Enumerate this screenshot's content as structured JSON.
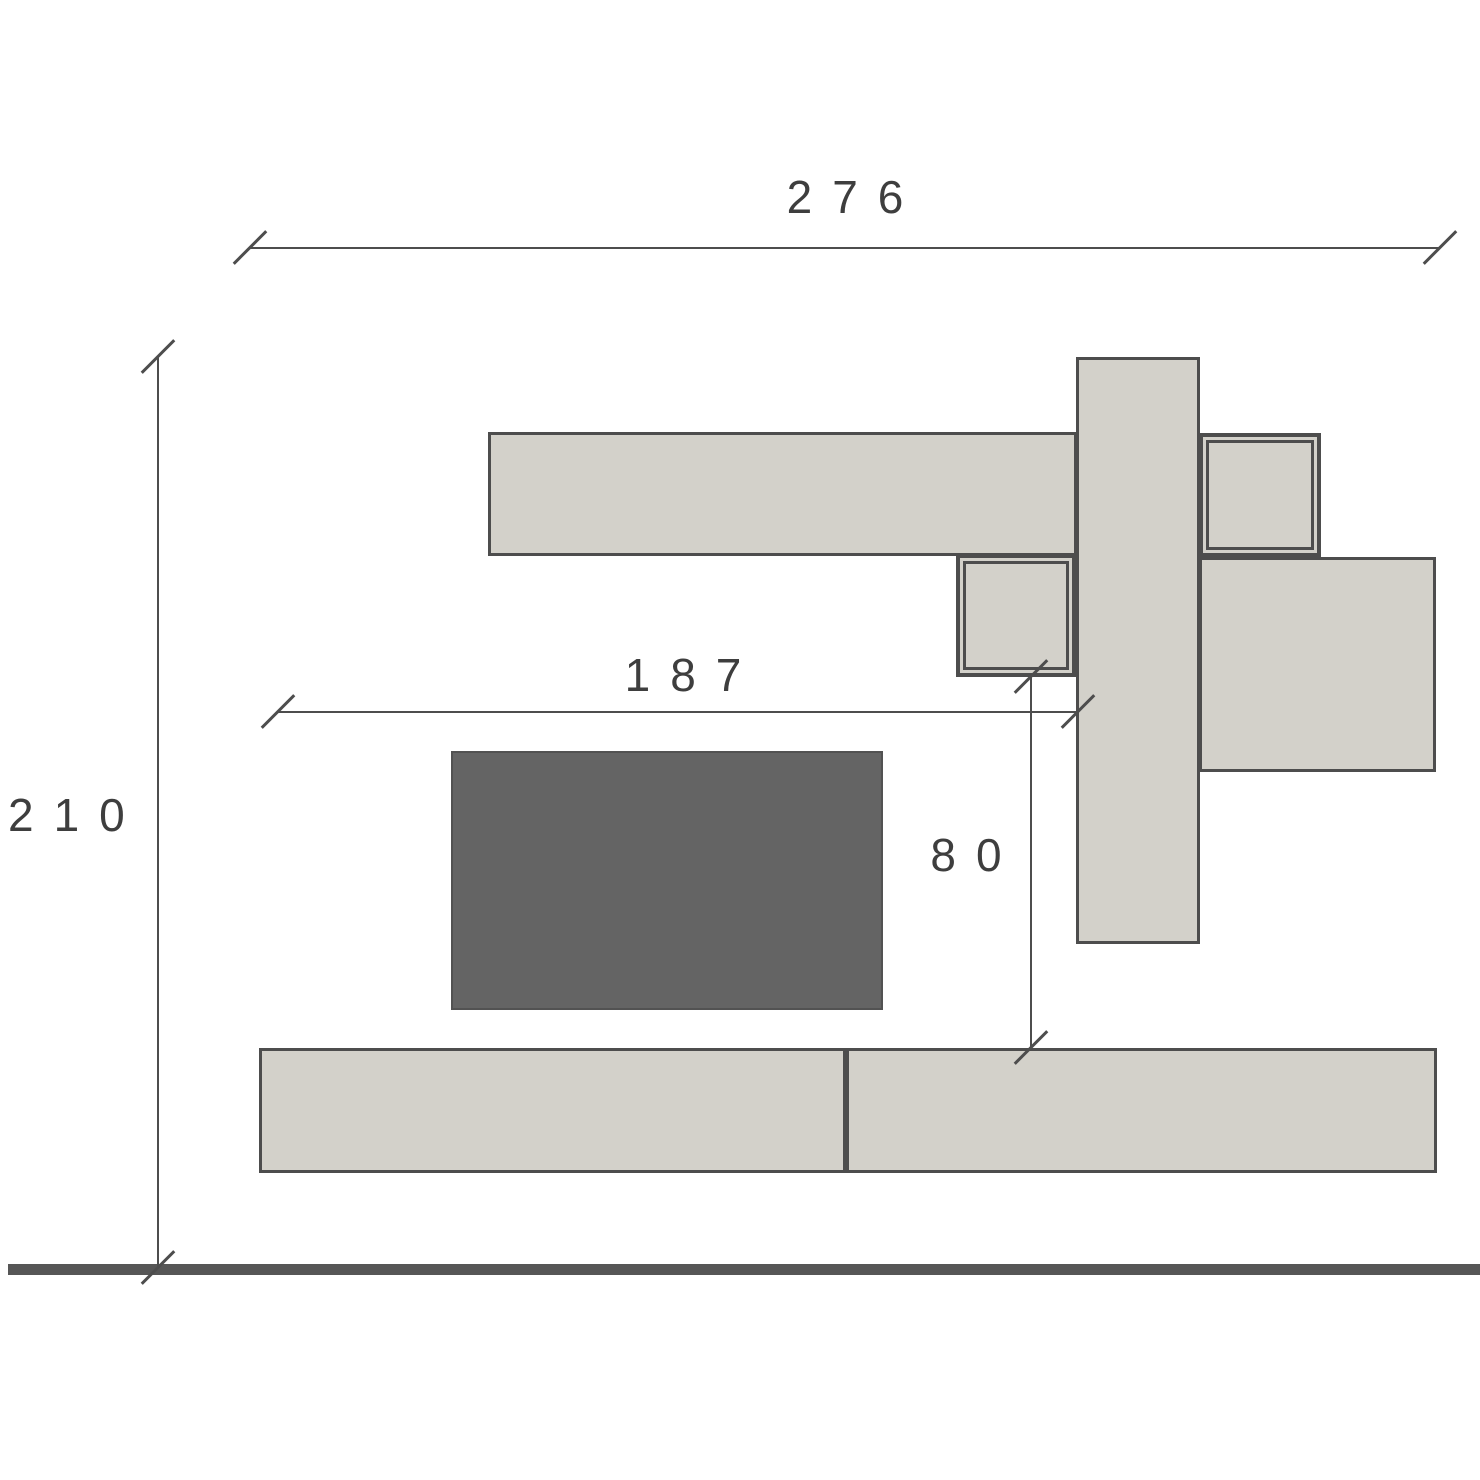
{
  "drawing": {
    "type": "furniture-wall-unit-elevation",
    "pieces": [
      "top-shelf",
      "tall-side-panel",
      "upper-right-cube",
      "middle-hanging-cube",
      "right-storage-box",
      "tv-screen",
      "base-cabinet-left-module",
      "base-cabinet-right-module",
      "floor-line"
    ]
  },
  "dimensions": {
    "total_width": "276",
    "total_height": "210",
    "inner_width": "187",
    "gap_height": "80"
  },
  "colors": {
    "background": "#ffffff",
    "outline": "#4d4d4d",
    "cabinet_fill": "#d3d1ca",
    "tv_fill": "#646464",
    "floor": "#565656",
    "dimension_text": "#3e3e3e"
  }
}
